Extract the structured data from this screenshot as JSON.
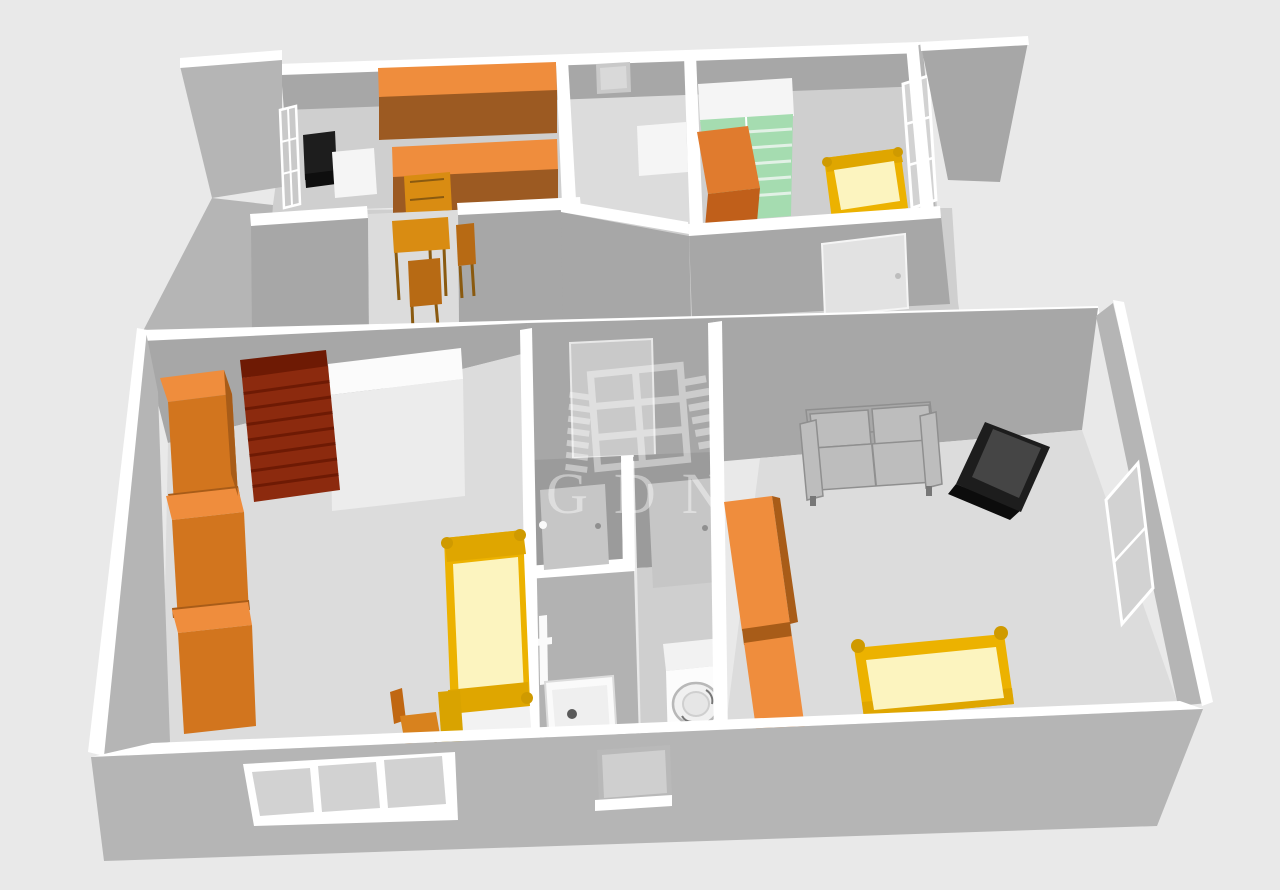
{
  "watermark": {
    "text": "GDN"
  },
  "palette": {
    "bg": "#e9e9e9",
    "wall_top": "#ffffff",
    "wall_face": "#a7a7a7",
    "wall_face_light": "#b5b5b5",
    "wall_face_dark": "#9b9b9b",
    "floor_light": "#dcdcdc",
    "floor_mid": "#cfcfcf",
    "floor_dim": "#c6c6c6",
    "floor_dark": "#b2b2b2",
    "orange_top": "#ef8d3d",
    "orange_front": "#d2751e",
    "orange_dark": "#a85c18",
    "brown_front": "#9c5a22",
    "cab_top": "#e07b2e",
    "cab_front": "#c05f1a",
    "red_top": "#6e1a04",
    "red_front": "#8c2a0e",
    "green_body": "#a5dcb0",
    "green_shelf": "#e2f1e6",
    "white_furniture": "#f5f5f5",
    "yellow_frame": "#ecb200",
    "yellow_mid": "#dfa600",
    "yellow_dark": "#cf9a00",
    "yellow_mattress": "#fcf4bf",
    "sofa_gray": "#a8a8a8",
    "sofa_light": "#bdbdbd",
    "sofa_dark": "#8f8f8f",
    "black_furniture": "#1d1d1d",
    "black_top": "#454545",
    "door_panel": "#c6c6c6",
    "desk_wood": "#d98c12",
    "chair_wood": "#b76a14",
    "watermark_color": "#ffffff"
  }
}
